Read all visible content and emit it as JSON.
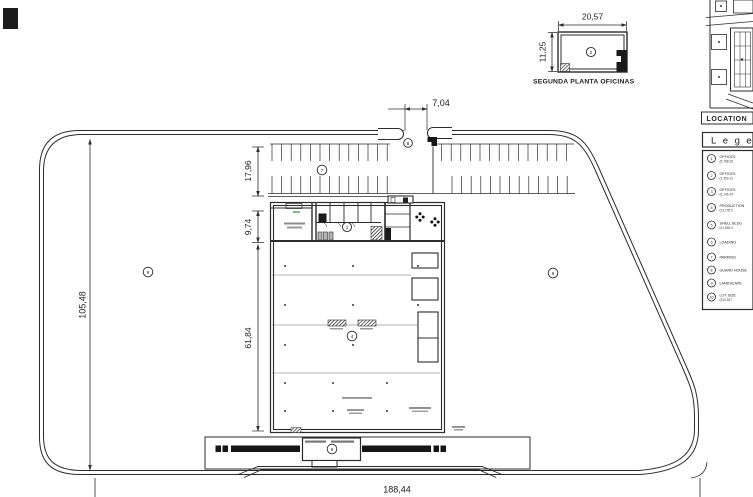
{
  "colors": {
    "ink": "#2c2c2c",
    "highlight_green": "#3aa83a"
  },
  "plan": {
    "dim_lot_width": "188,44",
    "dim_lot_height": "105,48",
    "dim_entrance": "7,04",
    "dim_parking_depth": "17,96",
    "dim_office_depth": "9,74",
    "dim_hall_depth": "61,84"
  },
  "detail": {
    "title": "SEGUNDA PLANTA OFICINAS",
    "dim_width": "20,57",
    "dim_height": "11,25"
  },
  "location_map": {
    "label": "LOCATION"
  },
  "legend": {
    "title": "Legend",
    "items": [
      {
        "num": "1",
        "label": "OFFICES",
        "area": "(5,788.28"
      },
      {
        "num": "2",
        "label": "OFFICES",
        "area": "(2,359.10"
      },
      {
        "num": "3",
        "label": "OFFICES",
        "area": "(6,146.45"
      },
      {
        "num": "4",
        "label": "PRODUCTION",
        "area": "(23,705.0"
      },
      {
        "num": "5",
        "label": "SHELL BLDG",
        "area": "(41,865.4"
      },
      {
        "num": "6",
        "label": "LOADING",
        "area": ""
      },
      {
        "num": "7",
        "label": "PARKING",
        "area": ""
      },
      {
        "num": "8",
        "label": "GUARD HOUSE",
        "area": ""
      },
      {
        "num": "9",
        "label": "LANDSCAPE",
        "area": ""
      },
      {
        "num": "10",
        "label": "LOT SIZE",
        "area": "(220,527"
      }
    ]
  },
  "markers": {
    "first_floor": "1",
    "second_floor": "2",
    "production": "4",
    "loading": "6",
    "parking": "7",
    "guard": "8",
    "landscape_a": "9",
    "landscape_b": "9"
  }
}
